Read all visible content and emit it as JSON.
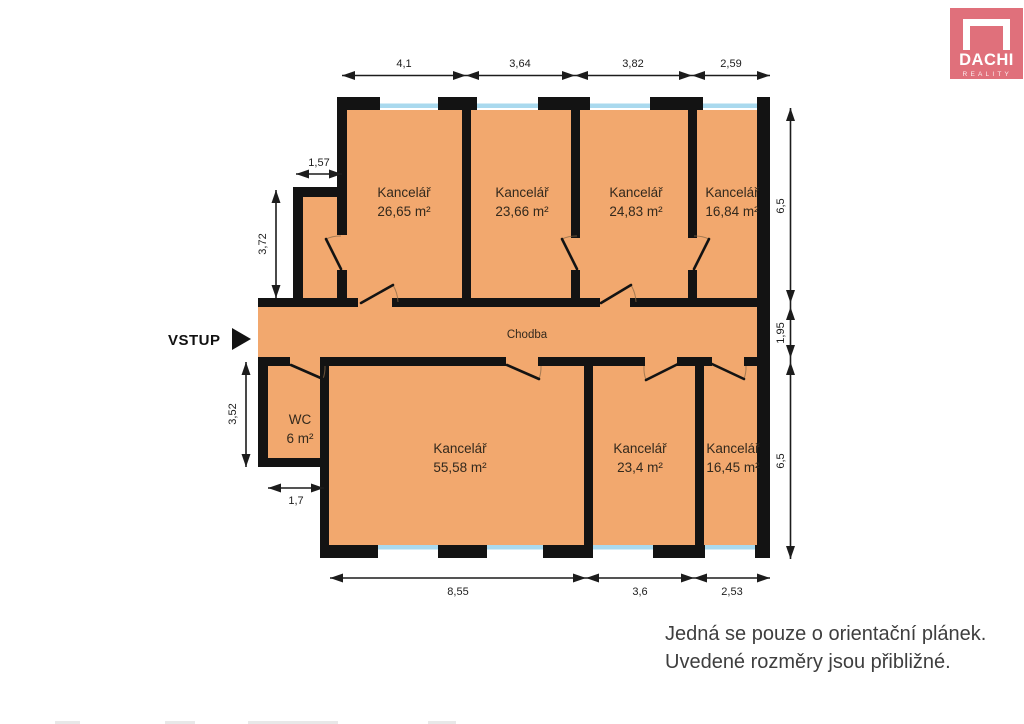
{
  "logo": {
    "brand": "DACHI",
    "tagline": "REALITY",
    "bg_color": "#e0707b"
  },
  "entrance": {
    "label": "VSTUP"
  },
  "corridor": {
    "label": "Chodba"
  },
  "rooms": {
    "top": [
      {
        "name": "Kancelář",
        "area": "26,65 m²"
      },
      {
        "name": "Kancelář",
        "area": "23,66 m²"
      },
      {
        "name": "Kancelář",
        "area": "24,83 m²"
      },
      {
        "name": "Kancelář",
        "area": "16,84 m²"
      }
    ],
    "bottom": [
      {
        "name": "WC",
        "area": "6 m²"
      },
      {
        "name": "Kancelář",
        "area": "55,58 m²"
      },
      {
        "name": "Kancelář",
        "area": "23,4 m²"
      },
      {
        "name": "Kancelář",
        "area": "16,45 m²"
      }
    ]
  },
  "dimensions": {
    "top": [
      "4,1",
      "3,64",
      "3,82",
      "2,59"
    ],
    "bottom": [
      "8,55",
      "3,6",
      "2,53"
    ],
    "right": [
      "6,5",
      "1,95",
      "6,5"
    ],
    "left": [
      "1,57",
      "3,72",
      "3,52",
      "1,7"
    ]
  },
  "disclaimer": {
    "line1": "Jedná se pouze o orientační plánek.",
    "line2": "Uvedené rozměry jsou přibližné."
  },
  "colors": {
    "room_fill": "#f2a86e",
    "wall": "#131313",
    "window": "#a9d9ee",
    "logo_bg": "#e0707b",
    "dimension_line": "#1c1c1c"
  }
}
